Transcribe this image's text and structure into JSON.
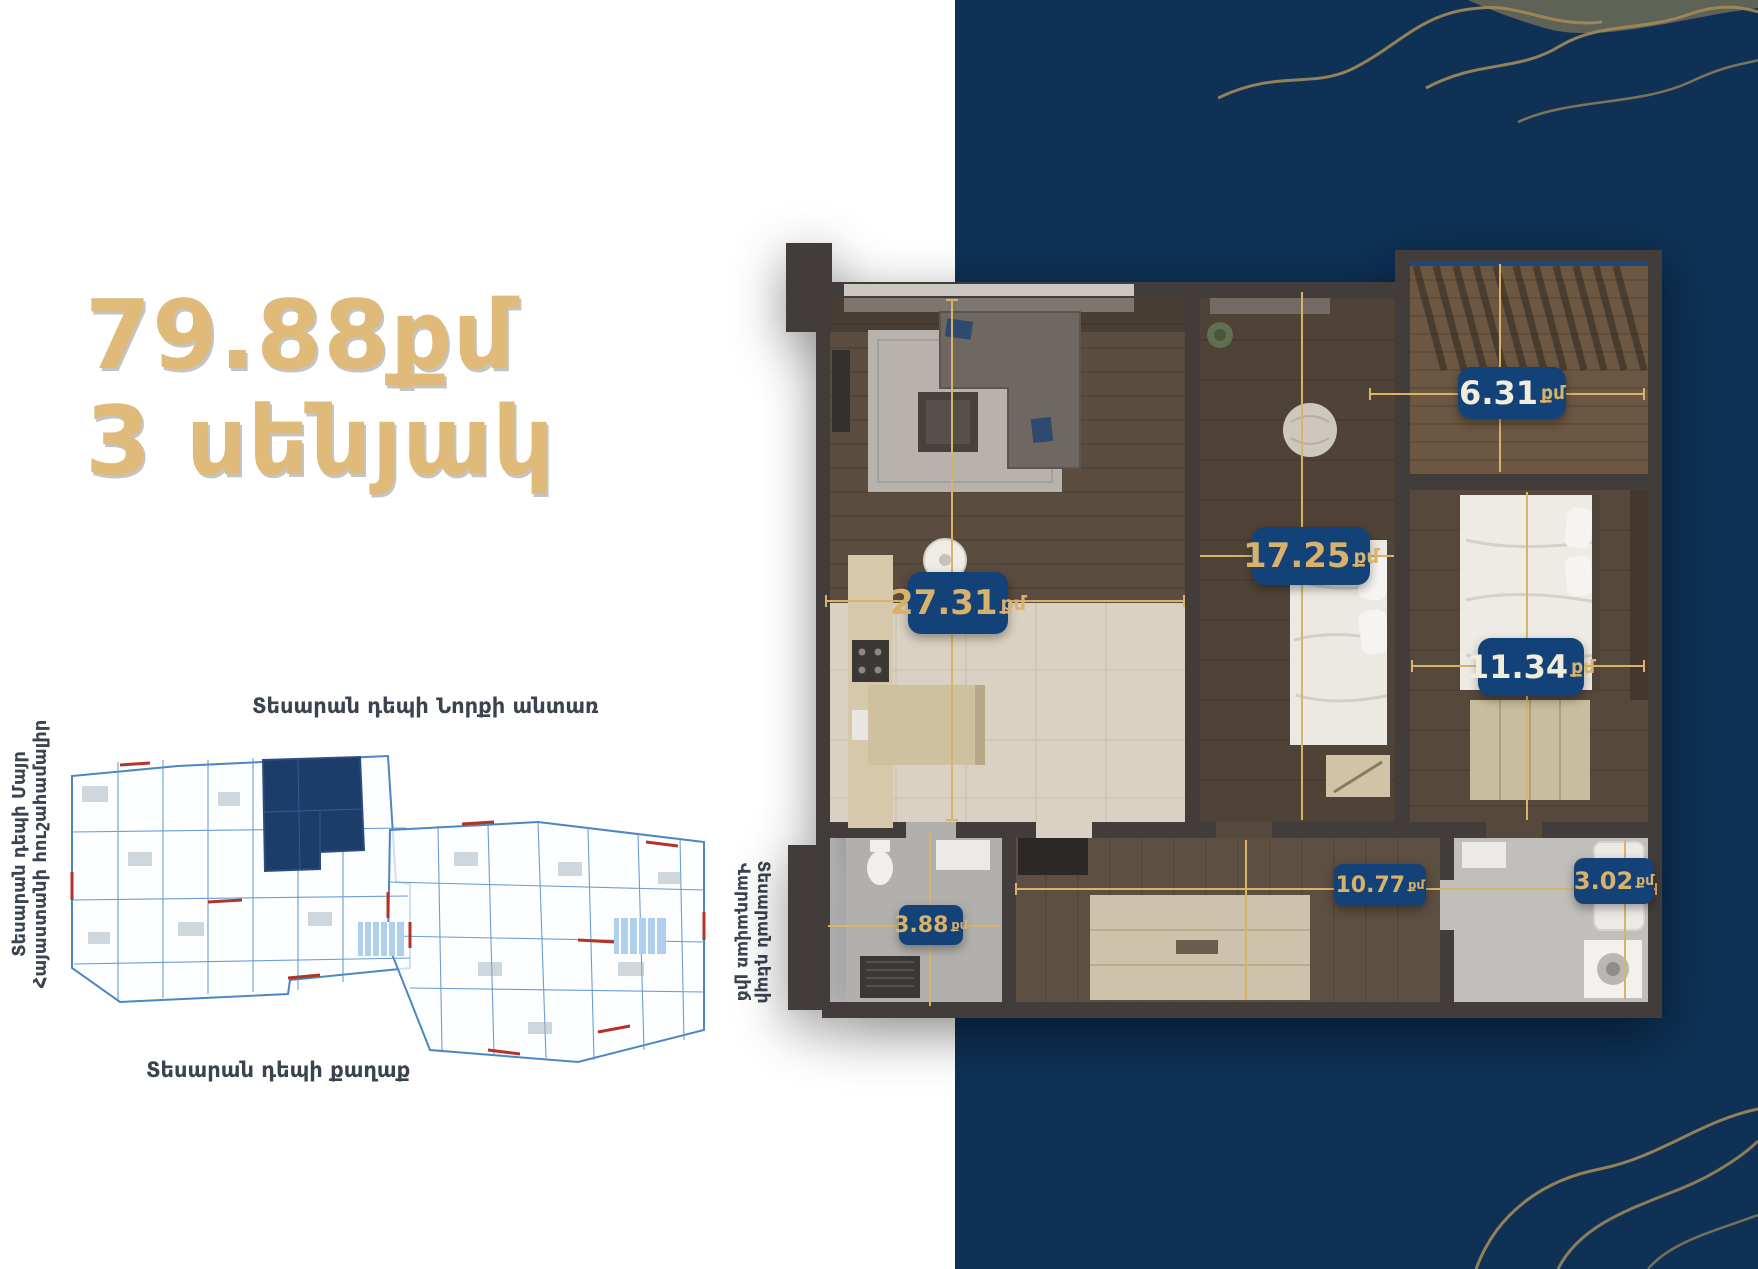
{
  "apartment": {
    "area_label": "79.88քմ",
    "rooms_label": "3 սենյակ"
  },
  "view_labels": {
    "top": "Տեսարան դեպի Նորքի անտառ",
    "left_line1": "Տեսարան դեպի Մայր",
    "left_line2": "Հայաստանի հուշահամալիր",
    "right_line1": "Տեսարան դեպի",
    "right_line2": "Վարդավառ լիճ",
    "bottom": "Տեսարան դեպի քաղաք"
  },
  "room_badges": [
    {
      "name": "living-room",
      "value": "27.31",
      "unit": "քմ"
    },
    {
      "name": "bedroom-1",
      "value": "17.25",
      "unit": "քմ"
    },
    {
      "name": "terrace",
      "value": "6.31",
      "unit": "քմ"
    },
    {
      "name": "bedroom-2",
      "value": "11.34",
      "unit": "քմ"
    },
    {
      "name": "bathroom-1",
      "value": "3.88",
      "unit": "քմ"
    },
    {
      "name": "hallway",
      "value": "10.77",
      "unit": "քմ"
    },
    {
      "name": "bathroom-2",
      "value": "3.02",
      "unit": "քմ"
    }
  ],
  "colors": {
    "navy_background": "#0E3155",
    "badge_navy": "#134279",
    "accent_gold": "#D8B26A",
    "title_gold": "#DFBA79",
    "blueprint_blue": "#4D86C4",
    "highlight_navy": "#1C3C69",
    "decoration_gold": "#A38B58"
  }
}
